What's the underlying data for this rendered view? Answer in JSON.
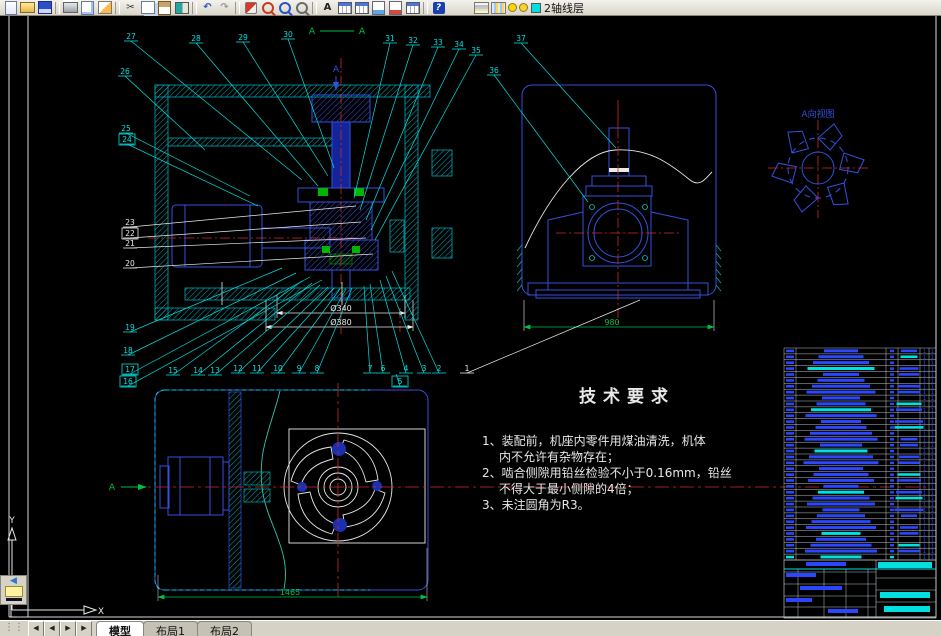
{
  "app": {
    "layer_name": "2轴线层"
  },
  "toolbar": {
    "items": [
      {
        "name": "qnew",
        "cls": "i-new"
      },
      {
        "name": "open",
        "cls": "i-open"
      },
      {
        "name": "save",
        "cls": "i-save"
      },
      {
        "sep": true
      },
      {
        "name": "plot",
        "cls": "i-plot"
      },
      {
        "name": "plot-preview",
        "cls": "i-preview"
      },
      {
        "name": "publish",
        "cls": "i-publish"
      },
      {
        "sep": true
      },
      {
        "name": "cut",
        "glyph": "✂",
        "color": "#333333"
      },
      {
        "name": "copy",
        "cls": "i-copy"
      },
      {
        "name": "paste",
        "cls": "i-paste"
      },
      {
        "name": "match-properties",
        "cls": "i-match"
      },
      {
        "sep": true
      },
      {
        "name": "undo",
        "glyph": "↶",
        "color": "#2a52c8"
      },
      {
        "name": "redo",
        "glyph": "↷",
        "color": "#9a9a9a"
      },
      {
        "sep": true
      },
      {
        "name": "pan-realtime",
        "cls": "i-pan"
      },
      {
        "name": "zoom-realtime",
        "cls": "i-mag mag-red"
      },
      {
        "name": "zoom-window",
        "cls": "i-mag mag-blue"
      },
      {
        "name": "zoom-previous",
        "cls": "i-mag mag-gray"
      },
      {
        "sep": true
      },
      {
        "name": "text-style",
        "glyph": "A",
        "color": "#222222"
      },
      {
        "name": "table-style",
        "cls": "i-table"
      },
      {
        "name": "table-edit",
        "cls": "i-table"
      },
      {
        "name": "sheet-set",
        "cls": "i-sheet-blue"
      },
      {
        "name": "markup",
        "cls": "i-sheet-red"
      },
      {
        "name": "grid",
        "cls": "i-table"
      },
      {
        "sep": true
      },
      {
        "name": "help",
        "glyph": "?",
        "cls": "i-help"
      },
      {
        "gap": true
      },
      {
        "name": "layer-properties",
        "cls": "i-layers"
      },
      {
        "name": "layer-previous",
        "cls": "i-layers2"
      }
    ],
    "layer_combo": {
      "bulb_color": "#ffd400",
      "sun_color": "#ffcf30",
      "chip_color": "#00e0e0"
    }
  },
  "drawing": {
    "view_labels": [
      {
        "id": "section-a-left",
        "text": "A",
        "x": 312,
        "y": 34,
        "color": "green",
        "size": 9
      },
      {
        "id": "section-a-right",
        "text": "A",
        "x": 362,
        "y": 34,
        "color": "green",
        "size": 9
      },
      {
        "id": "section-arrow-a",
        "text": "A",
        "x": 336,
        "y": 72,
        "color": "blue",
        "size": 9
      },
      {
        "id": "detail-view-label",
        "text": "A向视图",
        "x": 818,
        "y": 117,
        "color": "blue",
        "size": 9
      },
      {
        "id": "plan-section-a",
        "text": "A",
        "x": 112,
        "y": 490,
        "color": "green",
        "size": 9
      },
      {
        "id": "dim-phi340",
        "text": "Ø340",
        "x": 341,
        "y": 311,
        "color": "white",
        "size": 8
      },
      {
        "id": "dim-phi380",
        "text": "Ø380",
        "x": 341,
        "y": 325,
        "color": "white",
        "size": 8
      },
      {
        "id": "dim-endview",
        "text": "980",
        "x": 612,
        "y": 325,
        "color": "green",
        "size": 8
      },
      {
        "id": "dim-planview",
        "text": "1465",
        "x": 290,
        "y": 595,
        "color": "green",
        "size": 8
      },
      {
        "id": "ucs-y-label",
        "text": "Y",
        "x": 12,
        "y": 523,
        "color": "white",
        "size": 9
      },
      {
        "id": "ucs-x-label",
        "text": "X",
        "x": 101,
        "y": 614,
        "color": "white",
        "size": 9
      }
    ],
    "balloons": [
      {
        "n": "27",
        "x": 131,
        "y": 39,
        "tx": 302,
        "ty": 180
      },
      {
        "n": "28",
        "x": 196,
        "y": 41,
        "tx": 318,
        "ty": 186
      },
      {
        "n": "29",
        "x": 243,
        "y": 40,
        "tx": 328,
        "ty": 176
      },
      {
        "n": "30",
        "x": 288,
        "y": 37,
        "tx": 334,
        "ty": 168
      },
      {
        "n": "31",
        "x": 390,
        "y": 41,
        "tx": 354,
        "ty": 198
      },
      {
        "n": "32",
        "x": 413,
        "y": 43,
        "tx": 360,
        "ty": 210
      },
      {
        "n": "33",
        "x": 438,
        "y": 45,
        "tx": 366,
        "ty": 220
      },
      {
        "n": "34",
        "x": 459,
        "y": 47,
        "tx": 371,
        "ty": 230
      },
      {
        "n": "35",
        "x": 476,
        "y": 53,
        "tx": 375,
        "ty": 240
      },
      {
        "n": "36",
        "x": 494,
        "y": 73,
        "tx": 588,
        "ty": 202
      },
      {
        "n": "37",
        "x": 521,
        "y": 41,
        "tx": 616,
        "ty": 148
      },
      {
        "n": "26",
        "x": 125,
        "y": 74,
        "tx": 205,
        "ty": 150
      },
      {
        "n": "25",
        "x": 126,
        "y": 131,
        "tx": 250,
        "ty": 196
      },
      {
        "n": "24",
        "x": 127,
        "y": 142,
        "tx": 258,
        "ty": 206,
        "boxed": true
      },
      {
        "n": "23",
        "x": 130,
        "y": 225,
        "tx": 356,
        "ty": 206,
        "color": "white"
      },
      {
        "n": "22",
        "x": 130,
        "y": 236,
        "tx": 361,
        "ty": 222,
        "color": "white",
        "boxed": true
      },
      {
        "n": "21",
        "x": 130,
        "y": 246,
        "tx": 366,
        "ty": 238,
        "color": "white"
      },
      {
        "n": "20",
        "x": 130,
        "y": 266,
        "tx": 373,
        "ty": 254,
        "color": "white"
      },
      {
        "n": "19",
        "x": 130,
        "y": 330,
        "tx": 282,
        "ty": 268
      },
      {
        "n": "18",
        "x": 128,
        "y": 353,
        "tx": 296,
        "ty": 273
      },
      {
        "n": "17",
        "x": 130,
        "y": 372,
        "tx": 310,
        "ty": 277,
        "boxed": true
      },
      {
        "n": "16",
        "x": 128,
        "y": 384,
        "tx": 322,
        "ty": 280,
        "boxed": true
      },
      {
        "n": "15",
        "x": 173,
        "y": 373,
        "tx": 302,
        "ty": 281
      },
      {
        "n": "14",
        "x": 198,
        "y": 373,
        "tx": 312,
        "ty": 283
      },
      {
        "n": "13",
        "x": 215,
        "y": 373,
        "tx": 320,
        "ty": 285
      },
      {
        "n": "12",
        "x": 238,
        "y": 371,
        "tx": 328,
        "ty": 287
      },
      {
        "n": "11",
        "x": 257,
        "y": 371,
        "tx": 334,
        "ty": 288
      },
      {
        "n": "10",
        "x": 278,
        "y": 371,
        "tx": 340,
        "ty": 289
      },
      {
        "n": "9",
        "x": 299,
        "y": 371,
        "tx": 346,
        "ty": 289
      },
      {
        "n": "8",
        "x": 317,
        "y": 371,
        "tx": 352,
        "ty": 288
      },
      {
        "n": "7",
        "x": 370,
        "y": 371,
        "tx": 364,
        "ty": 286
      },
      {
        "n": "6",
        "x": 383,
        "y": 371,
        "tx": 370,
        "ty": 284
      },
      {
        "n": "5",
        "x": 400,
        "y": 384,
        "tx": 396,
        "ty": 374,
        "boxed": true
      },
      {
        "n": "4",
        "x": 406,
        "y": 371,
        "tx": 380,
        "ty": 280
      },
      {
        "n": "3",
        "x": 424,
        "y": 371,
        "tx": 386,
        "ty": 276
      },
      {
        "n": "2",
        "x": 439,
        "y": 371,
        "tx": 392,
        "ty": 271
      },
      {
        "n": "1",
        "x": 467,
        "y": 371,
        "tx": 640,
        "ty": 300,
        "color": "white"
      }
    ],
    "tech_req": {
      "title": "技术要求",
      "items": [
        {
          "text": "1、装配前，机座内零件用煤油清洗，机体",
          "indent": false
        },
        {
          "text": "内不允许有杂物存在；",
          "indent": true
        },
        {
          "text": "2、啮合侧隙用铅丝检验不小于0.16mm，铅丝",
          "indent": false
        },
        {
          "text": "不得大于最小侧隙的4倍；",
          "indent": true
        },
        {
          "text": "3、未注圆角为R3。",
          "indent": false
        }
      ]
    },
    "bom": {
      "rows": 36,
      "qty_char": "1"
    },
    "title_block": {
      "bars": [
        {
          "x": 878,
          "y": 562,
          "w": 54,
          "h": 6,
          "c": "cy"
        },
        {
          "x": 806,
          "y": 562,
          "w": 40,
          "h": 4,
          "c": "bl"
        },
        {
          "x": 786,
          "y": 573,
          "w": 30,
          "h": 4,
          "c": "bl"
        },
        {
          "x": 800,
          "y": 586,
          "w": 42,
          "h": 4,
          "c": "bl"
        },
        {
          "x": 786,
          "y": 598,
          "w": 26,
          "h": 4,
          "c": "bl"
        },
        {
          "x": 828,
          "y": 609,
          "w": 30,
          "h": 4,
          "c": "bl"
        },
        {
          "x": 880,
          "y": 592,
          "w": 50,
          "h": 6,
          "c": "cy"
        },
        {
          "x": 884,
          "y": 606,
          "w": 46,
          "h": 6,
          "c": "cy"
        }
      ]
    }
  },
  "statusbar": {
    "nav": [
      "◀",
      "◀",
      "▶",
      "▶"
    ],
    "grip": "⋮⋮"
  },
  "tabs": {
    "items": [
      "模型",
      "布局1",
      "布局2"
    ],
    "active": 0
  },
  "colors": {
    "cyan": "#00e0e0",
    "hatch": "#00a9b4",
    "blue": "#3350e0",
    "red": "#cf2b2b",
    "green": "#00c040",
    "white": "#e9e9e9",
    "bom_blue": "#2a46ff"
  }
}
